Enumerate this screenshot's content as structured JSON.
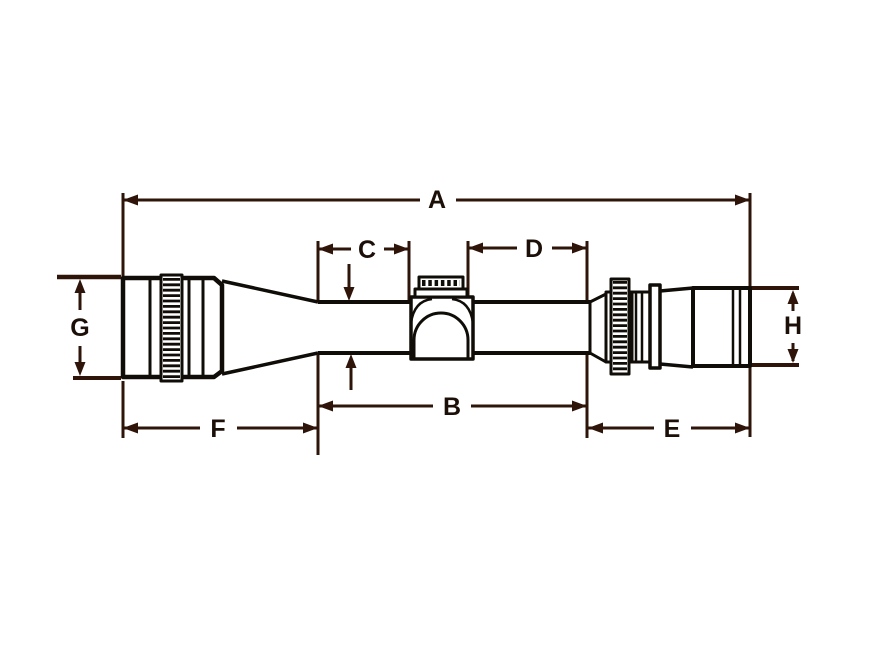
{
  "diagram": {
    "labels": {
      "a": "A",
      "b": "B",
      "c": "C",
      "d": "D",
      "e": "E",
      "f": "F",
      "g": "G",
      "h": "H"
    },
    "colors": {
      "background": "#ffffff",
      "outline": "#100c07",
      "dimension": "#2e1409",
      "label": "#1c0f08",
      "fill": "#ffffff"
    }
  }
}
